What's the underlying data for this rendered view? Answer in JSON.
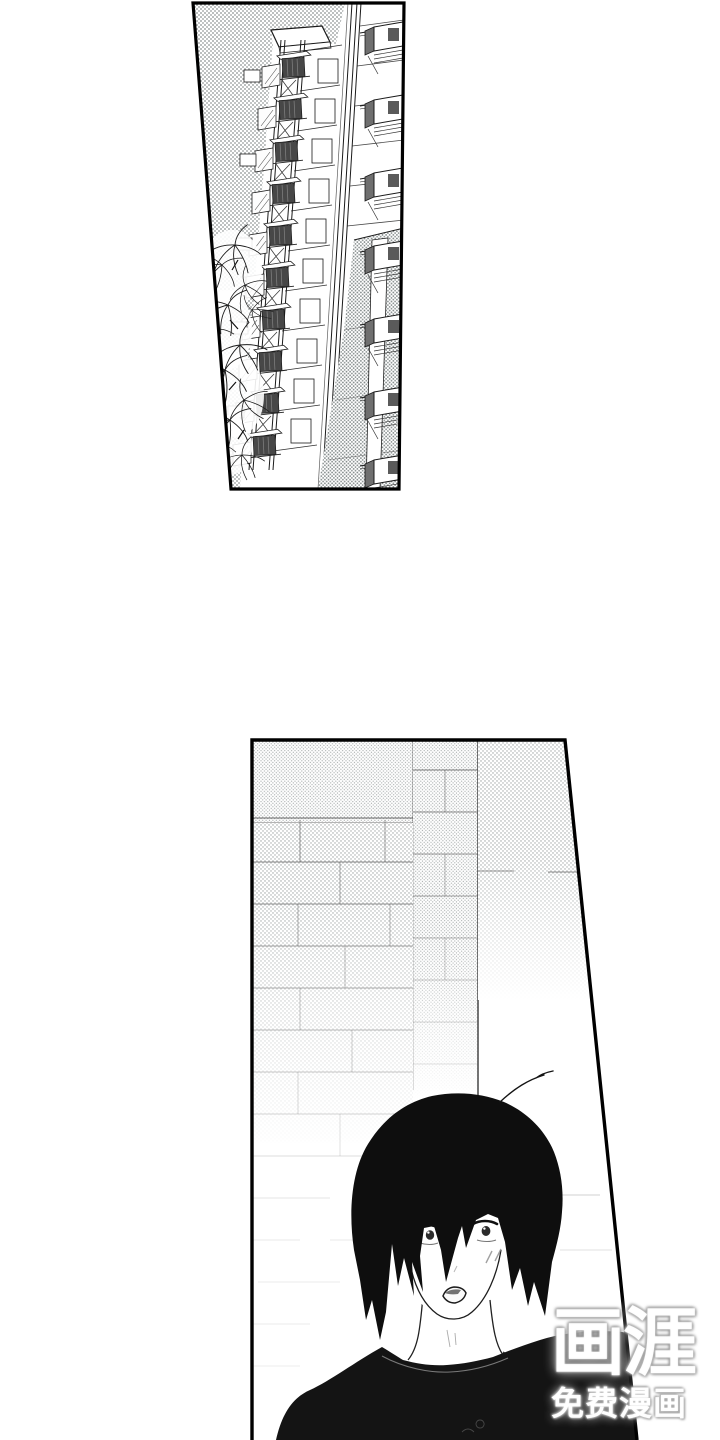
{
  "page": {
    "kind": "manga-reader-page",
    "width": 720,
    "height": 1440,
    "background": "#ffffff"
  },
  "panels": [
    {
      "name": "building-exterior",
      "alt": "Low-angle view of a tall apartment building with stacked balconies and a leafy tree against a dotted screentone sky"
    },
    {
      "name": "boy-brick-wall",
      "alt": "A black-haired young man in a dark t-shirt stands in front of a brick wall that fades to white, lips parted"
    }
  ],
  "watermark": {
    "logo": "画涯",
    "caption": "免费漫画"
  },
  "colors": {
    "ink": "#111111",
    "paper": "#ffffff",
    "hair": "#0e0e0e",
    "shirt": "#141414",
    "tone_dot": "#8d9292",
    "panel_border": "#000000",
    "watermark_text": "#ffffff",
    "watermark_halo": "#8a8a8a"
  }
}
